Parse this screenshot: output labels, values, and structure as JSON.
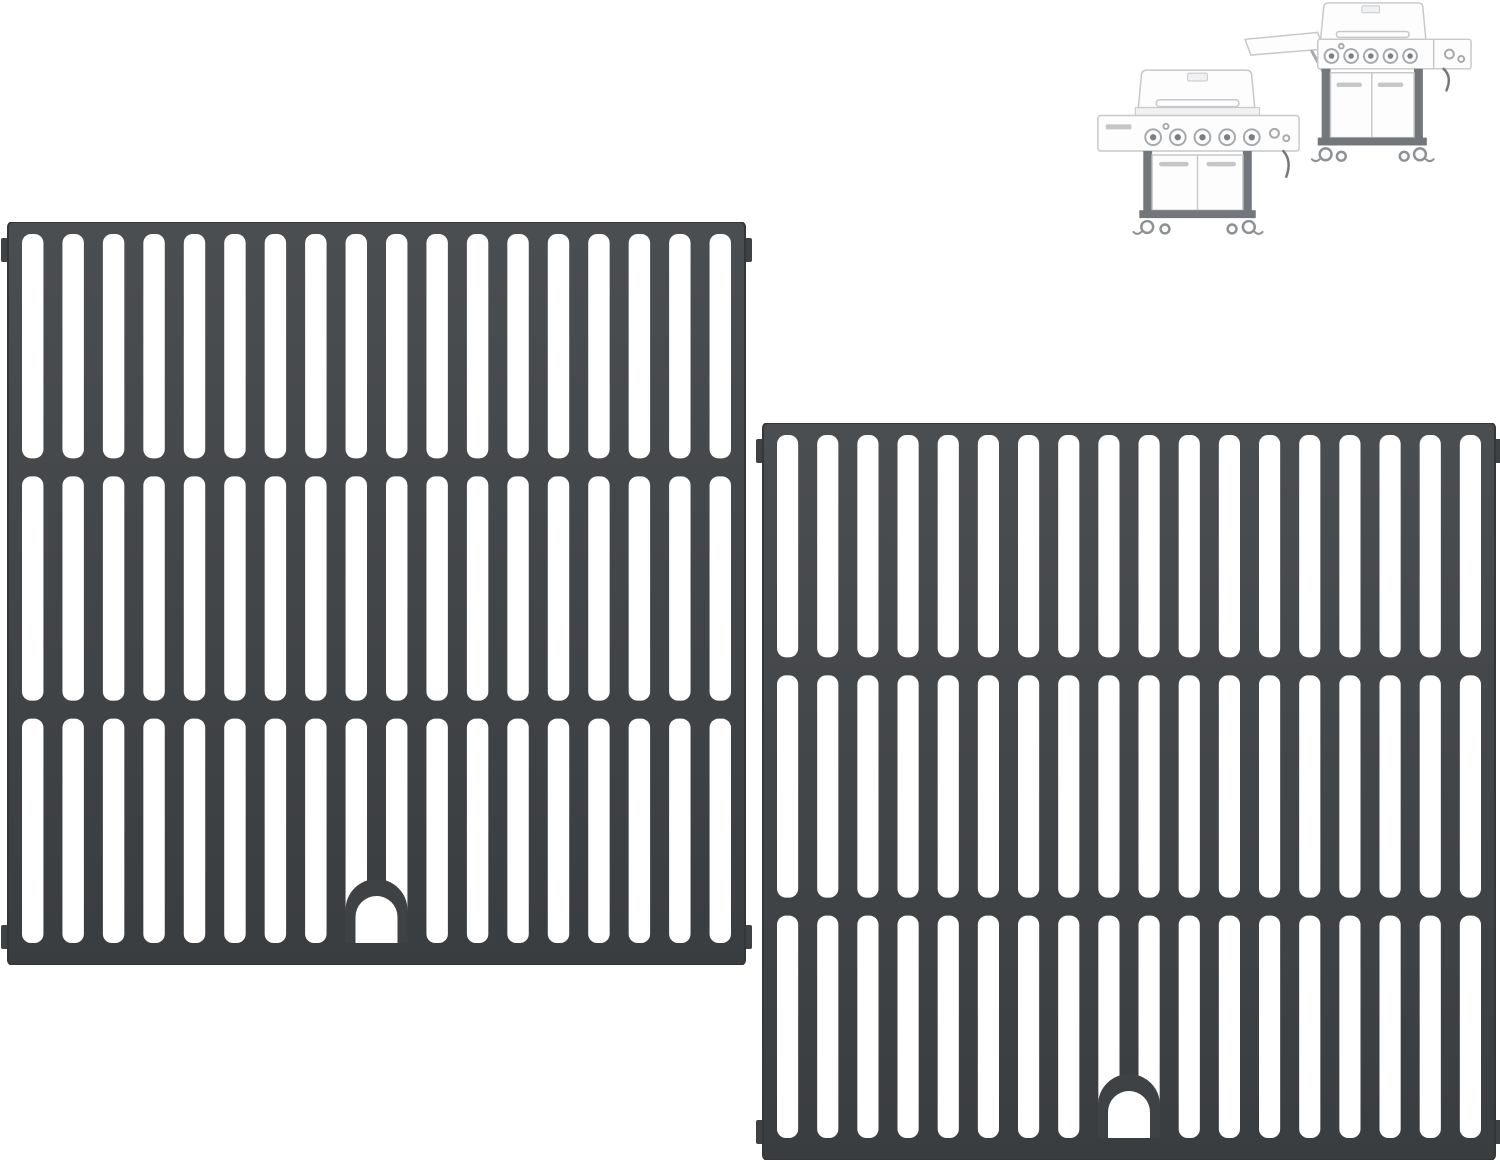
{
  "scene": {
    "background": "#ffffff",
    "label": "two matte cast-iron grill cooking grates with two faint gas-grill illustrations"
  },
  "colors": {
    "grate_dark": "#3f4245",
    "grate_dark_top": "#4b4e51",
    "grate_dark_bottom": "#3a3d40",
    "grate_outline": "#34373a",
    "slot_white": "#ffffff",
    "grill_line": "#c6c8ca",
    "grill_fill": "#fdfdfe",
    "grill_shade": "#f0f1f2",
    "grill_frame": "#73767a",
    "grill_handle": "#c4c6c8",
    "grill_knob": "#a7aaac",
    "grill_knob_dot": "#7c7f82",
    "grill_wheel": "#8e9193"
  },
  "grate_style": {
    "frame_side": 14,
    "top_rail": 12,
    "cross_rail": 18,
    "bottom_rail": 22,
    "bar_width": 19,
    "slot_radius": 9,
    "columns": 18,
    "rows": 3,
    "tab_width": 7,
    "tab_height": 24,
    "arch": {
      "outer_width": 62,
      "outer_height": 64,
      "inner_width": 42,
      "inner_height": 47
    }
  },
  "grates": [
    {
      "id": "left",
      "label": "cooking-grate-front",
      "x": 8,
      "y": 222,
      "width": 737,
      "height": 743
    },
    {
      "id": "right",
      "label": "cooking-grate-back",
      "x": 763,
      "y": 423,
      "width": 732,
      "height": 737
    }
  ],
  "grills": [
    {
      "id": "a",
      "label": "gas-grill-thumbnail-closed",
      "x": 1090,
      "y": 62,
      "width": 217,
      "height": 183
    },
    {
      "id": "b",
      "label": "gas-grill-thumbnail-side-shelf",
      "x": 1240,
      "y": 0,
      "width": 238,
      "height": 172
    }
  ]
}
